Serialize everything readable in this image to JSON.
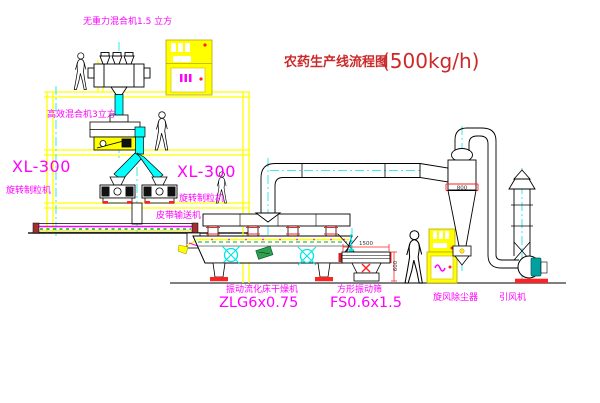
{
  "title": {
    "name": "农药生产线流程图",
    "capacity": "(500kg/h)"
  },
  "labels": {
    "gravity_mixer": "无重力混合机1.5 立方",
    "high_efficiency_mixer": "高效混合机3立方",
    "granulator_left_model": "XL-300",
    "granulator_left_name": "旋转制粒机",
    "granulator_right_model": "XL-300",
    "granulator_right_name": "旋转制粒机",
    "belt_conveyor": "皮带输送机",
    "dryer_name": "振动流化床干燥机",
    "dryer_model": "ZLG6x0.75",
    "sieve_name": "方形振动筛",
    "sieve_model": "FS0.6x1.5",
    "cyclone": "旋风除尘器",
    "induced_draft_fan": "引风机"
  },
  "dimensions": {
    "cyclone_inlet": "800",
    "sieve_length": "1500",
    "sieve_height": "600"
  },
  "palette": {
    "background": "#ffffff",
    "structure_yellow": "#ffff00",
    "machine_black": "#000000",
    "centerline_cyan": "#00ffff",
    "label_magenta": "#ff00ff",
    "title_red": "#cc2a2a",
    "accent_red": "#ff2222",
    "accent_green": "#00aa33",
    "fan_teal": "#00a0a0"
  }
}
